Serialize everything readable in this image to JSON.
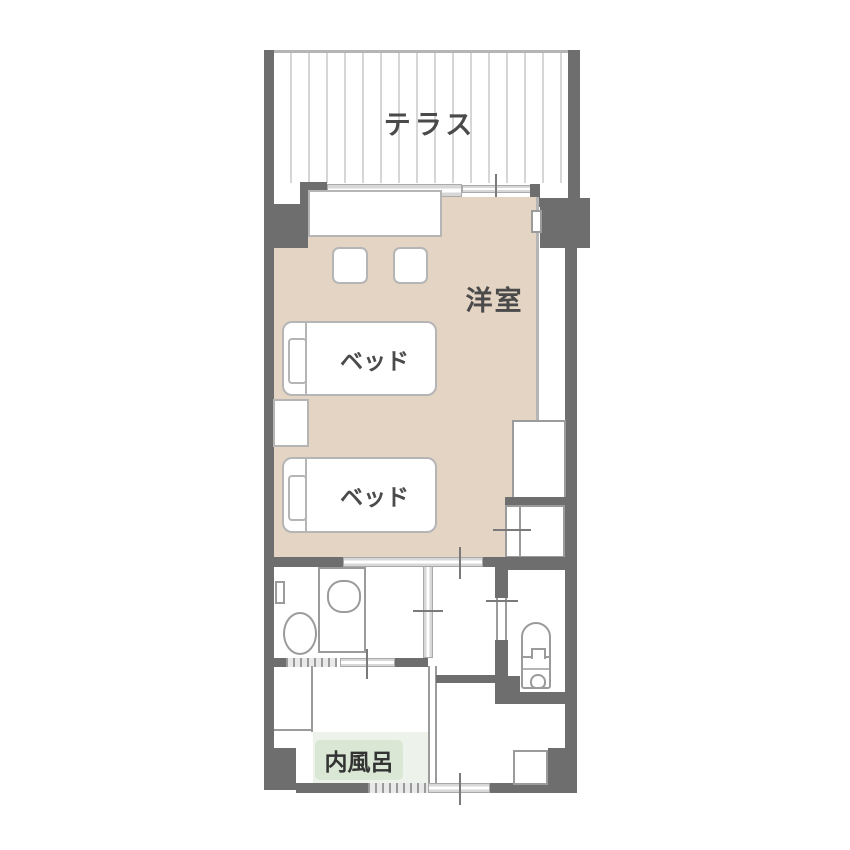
{
  "plan": {
    "type": "hotel-guestroom-floor-plan",
    "labels": {
      "terrace": "テラス",
      "western_room": "洋室",
      "bed1": "ベッド",
      "bed2": "ベッド",
      "indoor_bath": "内風呂"
    },
    "colors": {
      "wall": "#6e6e6e",
      "room_floor": "#e4d4c4",
      "bath_floor": "#edf2ea",
      "bath_label_bg": "#d9e7d4",
      "window_glass": "#d7d7d7",
      "fixture_outline": "#9b9b9b",
      "furniture_outline": "#b5b5b5",
      "label_text": "#4a4a4a",
      "background": "#ffffff"
    }
  }
}
